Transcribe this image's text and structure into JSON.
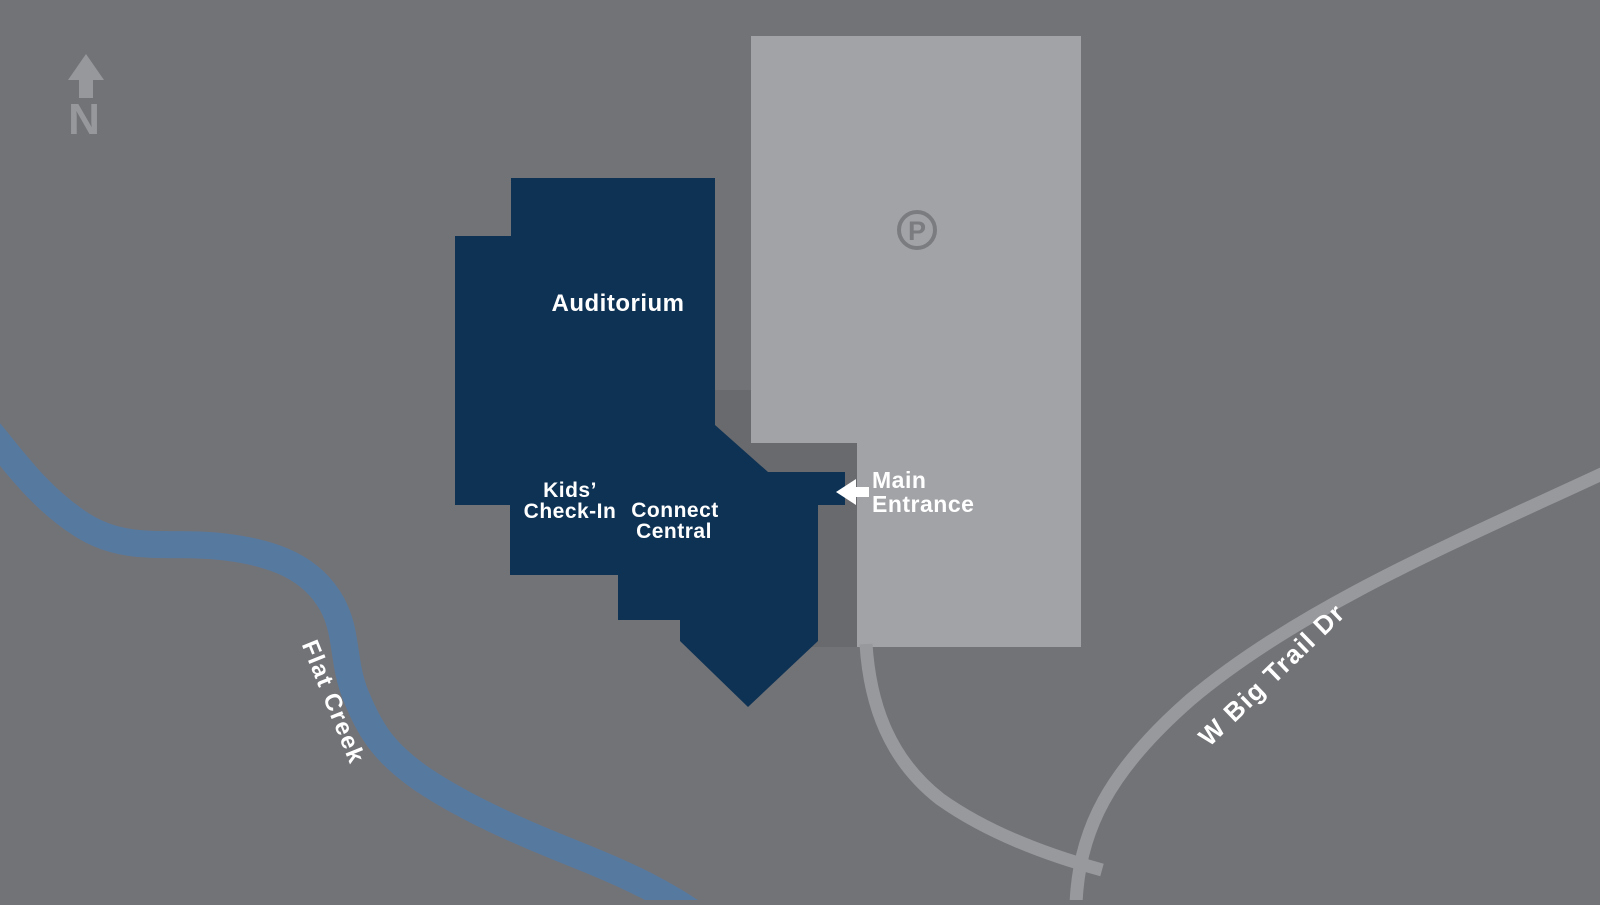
{
  "map": {
    "compass": {
      "label": "N"
    },
    "parking": {
      "icon_letter": "P"
    },
    "labels": {
      "auditorium": "Auditorium",
      "kids_line1": "Kids’",
      "kids_line2": "Check-In",
      "connect_line1": "Connect",
      "connect_line2": "Central",
      "entrance_line1": "Main",
      "entrance_line2": "Entrance",
      "creek": "Flat Creek",
      "road": "W Big Trail Dr"
    },
    "colors": {
      "background": "#727377",
      "building": "#0e3254",
      "parking_lot": "#a2a3a7",
      "walkway": "#686a6e",
      "road": "#98999d",
      "creek": "#5679a0",
      "label_text": "#ffffff",
      "compass": "#97989c",
      "parking_icon": "#7b7c80"
    }
  }
}
